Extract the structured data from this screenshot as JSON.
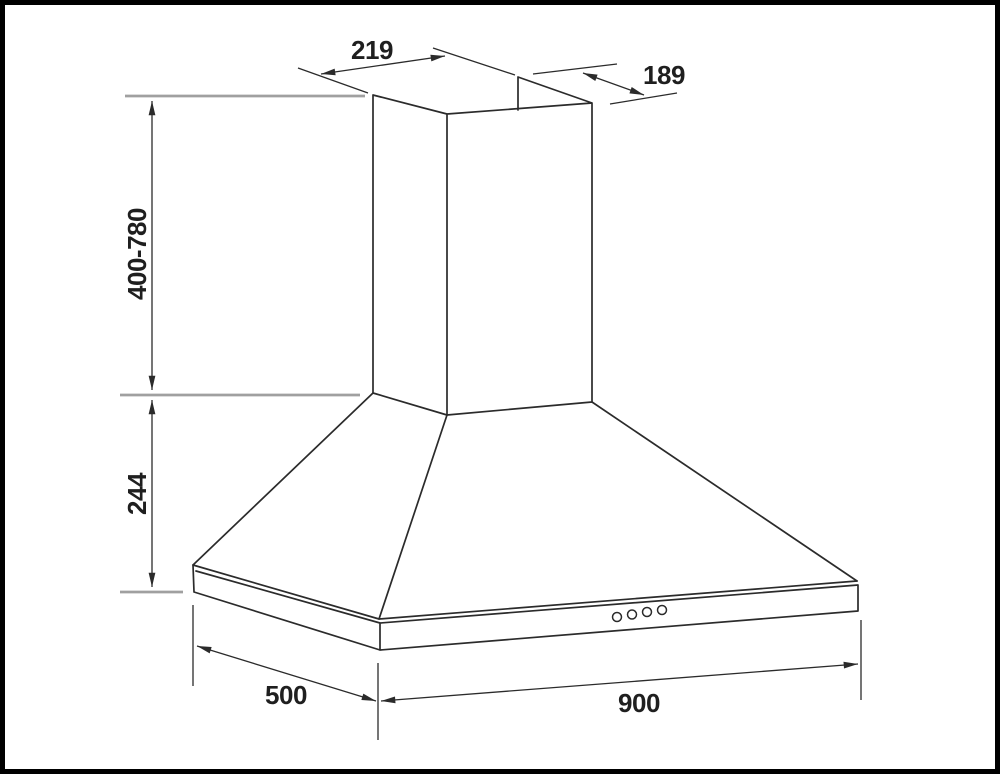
{
  "diagram": {
    "kind": "technical dimension drawing",
    "subject": "chimney cooker hood (isometric view)",
    "labels": {
      "chimney_top_width": "219",
      "chimney_top_depth": "189",
      "chimney_height_range": "400-780",
      "canopy_height": "244",
      "hood_depth": "500",
      "hood_width": "900"
    },
    "control_buttons_count": 4,
    "colors": {
      "line": "#2b2b2b",
      "extension_line": "#a0a0a0",
      "text": "#1f1f1f",
      "background": "#ffffff",
      "frame": "#000000"
    }
  }
}
